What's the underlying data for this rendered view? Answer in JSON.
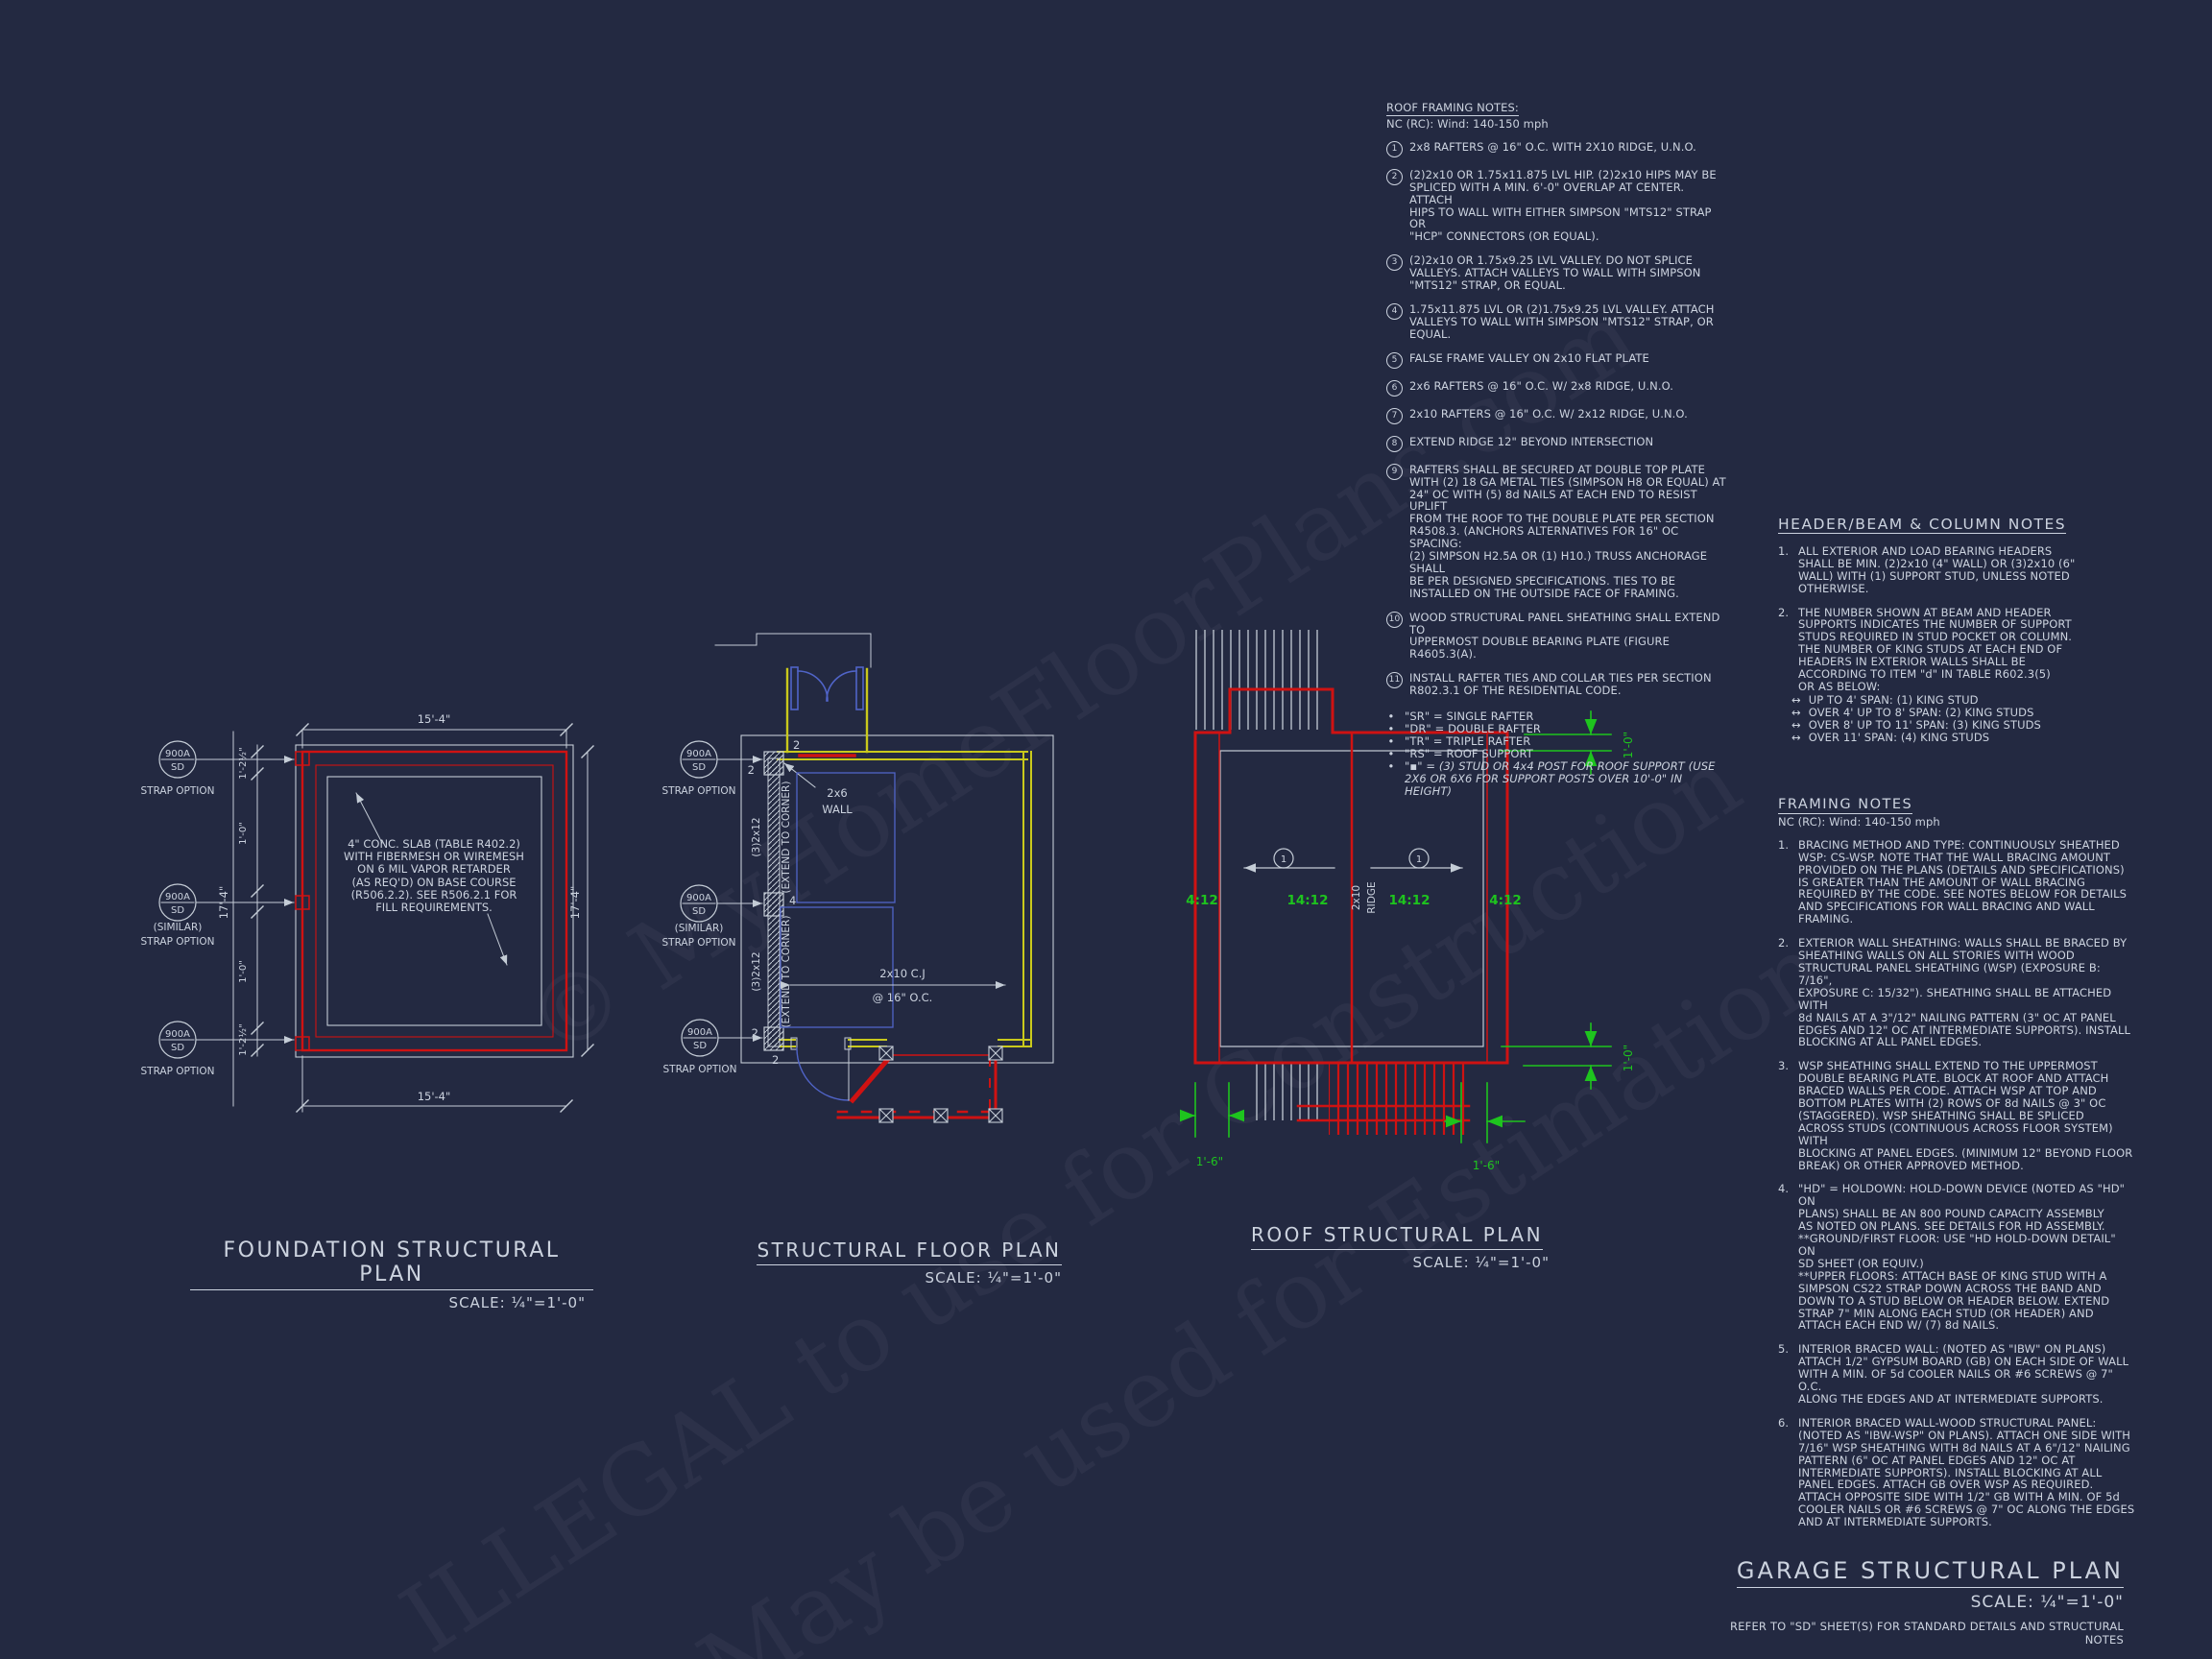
{
  "colors": {
    "background": "#232941",
    "line_white": "#c4ccd6",
    "line_red": "#cf1212",
    "line_yellow": "#c9c91c",
    "line_blue": "#5064c8",
    "line_green": "#1ec41e",
    "text": "#ccd3df"
  },
  "watermark": {
    "line1": "© MyHomeFloorPlans.com",
    "line2": "ILLEGAL to use for Construction",
    "line3": "May be used for Estimation"
  },
  "roof_framing_notes": {
    "title": "ROOF FRAMING NOTES:",
    "subtitle": "NC (RC): Wind: 140-150 mph",
    "items": [
      {
        "num": "1",
        "text": "2x8 RAFTERS @ 16\" O.C. WITH 2X10 RIDGE, U.N.O."
      },
      {
        "num": "2",
        "text": "(2)2x10 OR 1.75x11.875 LVL HIP.  (2)2x10 HIPS MAY BE\nSPLICED WITH A MIN. 6'-0\" OVERLAP AT CENTER. ATTACH\nHIPS TO WALL WITH EITHER SIMPSON \"MTS12\" STRAP OR\n\"HCP\" CONNECTORS (OR EQUAL)."
      },
      {
        "num": "3",
        "text": "(2)2x10 OR 1.75x9.25 LVL VALLEY.  DO NOT SPLICE\nVALLEYS.  ATTACH VALLEYS TO WALL WITH  SIMPSON\n\"MTS12\" STRAP, OR EQUAL."
      },
      {
        "num": "4",
        "text": "1.75x11.875 LVL OR (2)1.75x9.25 LVL VALLEY.  ATTACH\nVALLEYS TO WALL WITH SIMPSON \"MTS12\" STRAP, OR\nEQUAL."
      },
      {
        "num": "5",
        "text": "FALSE FRAME VALLEY ON 2x10 FLAT PLATE"
      },
      {
        "num": "6",
        "text": "2x6 RAFTERS @ 16\" O.C. W/ 2x8 RIDGE, U.N.O."
      },
      {
        "num": "7",
        "text": "2x10 RAFTERS @ 16\" O.C. W/ 2x12 RIDGE, U.N.O."
      },
      {
        "num": "8",
        "text": "EXTEND RIDGE 12\" BEYOND INTERSECTION"
      },
      {
        "num": "9",
        "text": "RAFTERS SHALL BE SECURED AT DOUBLE TOP PLATE\nWITH (2) 18 GA METAL TIES (SIMPSON H8 OR EQUAL) AT\n24\" OC WITH (5) 8d NAILS AT EACH END TO RESIST UPLIFT\nFROM THE ROOF TO THE DOUBLE PLATE PER SECTION\nR4508.3. (ANCHORS ALTERNATIVES FOR 16\" OC SPACING:\n(2) SIMPSON H2.5A OR (1) H10.) TRUSS ANCHORAGE SHALL\nBE PER DESIGNED SPECIFICATIONS. TIES TO BE\nINSTALLED ON THE OUTSIDE FACE OF FRAMING."
      },
      {
        "num": "10",
        "text": "WOOD STRUCTURAL PANEL SHEATHING SHALL EXTEND TO\nUPPERMOST DOUBLE BEARING PLATE (FIGURE R4605.3(A)."
      },
      {
        "num": "11",
        "text": "INSTALL RAFTER TIES AND COLLAR TIES PER SECTION\nR802.3.1 OF THE  RESIDENTIAL CODE."
      }
    ],
    "legend": [
      {
        "bullet": "•",
        "text": "\"SR\"  = SINGLE RAFTER"
      },
      {
        "bullet": "•",
        "text": "\"DR\" = DOUBLE RAFTER"
      },
      {
        "bullet": "•",
        "text": "\"TR\" = TRIPLE RAFTER"
      },
      {
        "bullet": "•",
        "text": "\"RS\" = ROOF SUPPORT"
      },
      {
        "bullet": "•",
        "text": "\"▪\" = (3) STUD OR 4x4 POST FOR ROOF SUPPORT (USE\n2X6 OR 6X6 FOR SUPPORT POSTS OVER 10'-0\" IN HEIGHT)"
      }
    ]
  },
  "header_notes": {
    "title": "HEADER/BEAM & COLUMN NOTES",
    "items": [
      {
        "num": "1.",
        "text": "ALL EXTERIOR AND LOAD BEARING HEADERS\nSHALL BE MIN. (2)2x10 (4\" WALL) OR (3)2x10 (6\"\nWALL) WITH (1) SUPPORT STUD, UNLESS NOTED\nOTHERWISE."
      },
      {
        "num": "2.",
        "text": "THE NUMBER SHOWN AT BEAM AND HEADER\nSUPPORTS INDICATES THE NUMBER OF SUPPORT\nSTUDS REQUIRED IN STUD POCKET OR COLUMN.\nTHE NUMBER OF KING STUDS AT EACH END OF\nHEADERS IN EXTERIOR WALLS SHALL BE\nACCORDING TO ITEM \"d\" IN TABLE R602.3(5)\nOR AS BELOW:"
      }
    ],
    "bullets": [
      {
        "glyph": "↔",
        "text": "UP TO 4' SPAN: (1) KING STUD"
      },
      {
        "glyph": "↔",
        "text": "OVER 4' UP TO 8' SPAN: (2) KING STUDS"
      },
      {
        "glyph": "↔",
        "text": "OVER 8' UP TO 11' SPAN: (3) KING STUDS"
      },
      {
        "glyph": "↔",
        "text": "OVER 11' SPAN: (4) KING STUDS"
      }
    ]
  },
  "framing_notes": {
    "title": "FRAMING NOTES",
    "subtitle": "NC (RC): Wind: 140-150 mph",
    "items": [
      {
        "num": "1.",
        "text": "BRACING METHOD AND TYPE: CONTINUOUSLY SHEATHED\nWSP: CS-WSP. NOTE THAT THE WALL BRACING AMOUNT\nPROVIDED ON THE PLANS (DETAILS AND SPECIFICATIONS)\nIS GREATER THAN THE AMOUNT OF WALL BRACING\nREQUIRED BY THE CODE. SEE NOTES BELOW FOR DETAILS\nAND SPECIFICATIONS FOR WALL BRACING AND WALL\nFRAMING."
      },
      {
        "num": "2.",
        "text": "EXTERIOR WALL SHEATHING: WALLS SHALL BE BRACED BY\nSHEATHING WALLS ON ALL STORIES WITH WOOD\nSTRUCTURAL PANEL SHEATHING (WSP) (EXPOSURE B: 7/16\",\nEXPOSURE C: 15/32\"). SHEATHING SHALL BE ATTACHED WITH\n8d NAILS AT A 3\"/12\" NAILING PATTERN (3\" OC AT PANEL\nEDGES AND 12\" OC AT INTERMEDIATE SUPPORTS). INSTALL\nBLOCKING AT ALL PANEL EDGES."
      },
      {
        "num": "3.",
        "text": "WSP SHEATHING SHALL EXTEND TO THE UPPERMOST\nDOUBLE BEARING PLATE. BLOCK AT ROOF AND ATTACH\nBRACED WALLS PER CODE. ATTACH WSP AT TOP AND\nBOTTOM PLATES WITH (2) ROWS OF 8d NAILS @ 3\" OC\n(STAGGERED).  WSP SHEATHING SHALL BE SPLICED\nACROSS STUDS (CONTINUOUS ACROSS FLOOR SYSTEM) WITH\nBLOCKING AT PANEL EDGES. (MINIMUM 12\" BEYOND FLOOR\nBREAK) OR OTHER APPROVED METHOD."
      },
      {
        "num": "4.",
        "text": "\"HD\" = HOLDOWN: HOLD-DOWN DEVICE (NOTED AS \"HD\" ON\nPLANS) SHALL BE AN 800 POUND CAPACITY ASSEMBLY\nAS NOTED ON PLANS. SEE DETAILS FOR HD ASSEMBLY.\n**GROUND/FIRST FLOOR:  USE \"HD HOLD-DOWN DETAIL\" ON\nSD SHEET (OR EQUIV.)\n**UPPER FLOORS: ATTACH BASE OF KING STUD WITH A\nSIMPSON CS22 STRAP DOWN ACROSS THE BAND AND\nDOWN TO A STUD BELOW OR HEADER BELOW.  EXTEND\nSTRAP 7\" MIN ALONG EACH STUD (OR HEADER) AND\nATTACH EACH END W/ (7) 8d NAILS."
      },
      {
        "num": "5.",
        "text": "INTERIOR BRACED WALL: (NOTED AS \"IBW\" ON PLANS)\nATTACH 1/2\" GYPSUM BOARD (GB) ON EACH SIDE OF WALL\nWITH A MIN. OF 5d COOLER NAILS OR #6 SCREWS @ 7\" O.C.\nALONG THE EDGES AND AT INTERMEDIATE SUPPORTS."
      },
      {
        "num": "6.",
        "text": "INTERIOR BRACED WALL-WOOD STRUCTURAL PANEL:\n(NOTED AS \"IBW-WSP\" ON PLANS). ATTACH ONE SIDE WITH\n7/16\" WSP SHEATHING WITH 8d NAILS AT A 6\"/12\" NAILING\nPATTERN (6\" OC AT PANEL EDGES AND 12\" OC AT\nINTERMEDIATE SUPPORTS). INSTALL BLOCKING AT ALL\nPANEL EDGES. ATTACH GB OVER WSP AS REQUIRED.\nATTACH OPPOSITE SIDE WITH 1/2\" GB WITH A MIN. OF 5d\nCOOLER NAILS OR #6 SCREWS @ 7\" OC ALONG THE EDGES\nAND AT INTERMEDIATE SUPPORTS."
      }
    ]
  },
  "plans": {
    "foundation": {
      "title": "FOUNDATION STRUCTURAL PLAN",
      "scale": "SCALE: ¼\"=1'-0\"",
      "dim_top": "15'-4\"",
      "dim_bottom": "15'-4\"",
      "dim_left": "17'-4\"",
      "dim_right": "17'-4\"",
      "seg1": "1'-2½\"",
      "seg2": "1'-0\"",
      "seg3": "1'-0\"",
      "seg4": "1'-2½\"",
      "bubble_top": "900A",
      "bubble_bottom": "SD",
      "label1": "STRAP OPTION",
      "label2a": "(SIMILAR)",
      "label2b": "STRAP OPTION",
      "label3": "STRAP OPTION",
      "slab_note": "4\" CONC. SLAB (TABLE R402.2)\nWITH FIBERMESH OR WIREMESH\nON 6 MIL VAPOR RETARDER\n(AS REQ'D) ON BASE COURSE\n(R506.2.2). SEE R506.2.1 FOR\nFILL REQUIREMENTS."
    },
    "floor": {
      "title": "STRUCTURAL FLOOR PLAN",
      "scale": "SCALE: ¼\"=1'-0\"",
      "bubble_top": "900A",
      "bubble_bottom": "SD",
      "label1": "STRAP OPTION",
      "label2a": "(SIMILAR)",
      "label2b": "STRAP OPTION",
      "label3": "STRAP OPTION",
      "wall_label_1": "2x6",
      "wall_label_2": "WALL",
      "member_label": "(3)2x12",
      "member_note": "(EXTEND TO CORNER)",
      "joist_label_1": "2x10 C.J",
      "joist_label_2": "@ 16\" O.C.",
      "counts": [
        "2",
        "2",
        "4",
        "2",
        "2"
      ]
    },
    "roof": {
      "title": "ROOF STRUCTURAL PLAN",
      "scale": "SCALE: ¼\"=1'-0\"",
      "slopes": [
        "4:12",
        "14:12",
        "14:12",
        "4:12"
      ],
      "ridge_1": "2x10",
      "ridge_2": "RIDGE",
      "note_ref": "1",
      "dim_right_top": "1'-0\"",
      "dim_right_bottom": "1'-0\"",
      "dim_bottom_left": "1'-6\"",
      "dim_bottom_right": "1'-6\""
    }
  },
  "title_block": {
    "title": "GARAGE STRUCTURAL PLAN",
    "scale": "SCALE: ¼\"=1'-0\"",
    "note": "REFER TO \"SD\" SHEET(S) FOR STANDARD DETAILS AND STRUCTURAL NOTES"
  }
}
